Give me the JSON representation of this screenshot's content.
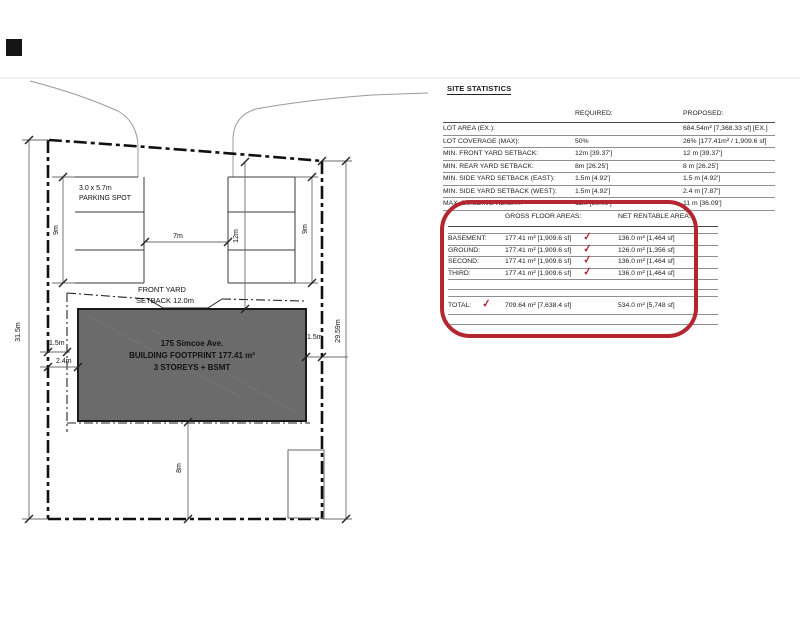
{
  "colors": {
    "highlight_red": "#b32731",
    "building_gray": "#6b6b6b",
    "marker_black": "#151515"
  },
  "site_plan": {
    "parking": {
      "size": "3.0 x 5.7m",
      "label": "PARKING SPOT"
    },
    "front_yard": {
      "line1": "FRONT YARD",
      "line2": "SETBACK 12.0m"
    },
    "building": {
      "address": "175 Simcoe Ave.",
      "footprint": "BUILDING FOOTPRINT 177.41 m²",
      "storeys": "3 STOREYS + BSMT"
    },
    "dims": {
      "lot_west": "31.5m",
      "lot_east": "29.59m",
      "parking_west": "9m",
      "parking_east": "9m",
      "parking_gap": "7m",
      "front_yard": "12m",
      "rear_yard": "8m",
      "side_west_setback": "1.5m",
      "side_west_building": "2.4m",
      "side_east": "1.5m"
    }
  },
  "stats": {
    "title": "SITE STATISTICS",
    "columns": {
      "required": "REQUIRED:",
      "proposed": "PROPOSED:"
    },
    "rows": [
      {
        "label": "LOT AREA (EX.):",
        "required": "",
        "proposed": "684.54m² [7,368.33 sf] [EX.]"
      },
      {
        "label": "LOT COVERAGE (MAX):",
        "required": "50%",
        "proposed": "26% [177.41m² / 1,909.6 sf]"
      },
      {
        "label": "MIN. FRONT YARD SETBACK:",
        "required": "12m [39.37']",
        "proposed": "12 m [39.37']"
      },
      {
        "label": "MIN. REAR YARD SETBACK:",
        "required": "8m [26.25']",
        "proposed": "8 m [26.25']"
      },
      {
        "label": "MIN. SIDE YARD SETBACK (EAST):",
        "required": "1.5m [4.92']",
        "proposed": "1.5 m [4.92']"
      },
      {
        "label": "MIN. SIDE YARD SETBACK (WEST):",
        "required": "1.5m [4.92']",
        "proposed": "2.4 m [7.87']"
      },
      {
        "label": "MAX. BUILDING HEIGHT:",
        "required": "11m [36.09']",
        "proposed": "11 m [36.09']"
      }
    ]
  },
  "floor_areas": {
    "check_glyph": "✓",
    "columns": {
      "gross": "GROSS FLOOR AREAS:",
      "net": "NET RENTABLE AREA:"
    },
    "rows": [
      {
        "label": "BASEMENT:",
        "gross": "177.41 m² [1,909.6 sf]",
        "net": "136.0 m² [1,464 sf]"
      },
      {
        "label": "GROUND:",
        "gross": "177.41 m² [1,909.6 sf]",
        "net": "126.0 m² [1,356 sf]"
      },
      {
        "label": "SECOND:",
        "gross": "177.41 m² [1,909.6 sf]",
        "net": "136.0 m² [1,464 sf]"
      },
      {
        "label": "THIRD:",
        "gross": "177.41 m² [1,909.6 sf]",
        "net": "136.0 m² [1,464 sf]"
      }
    ],
    "total": {
      "label": "TOTAL:",
      "gross": "709.64 m² [7,638.4 sf]",
      "net": "534.0 m² [5,748 sf]"
    }
  }
}
